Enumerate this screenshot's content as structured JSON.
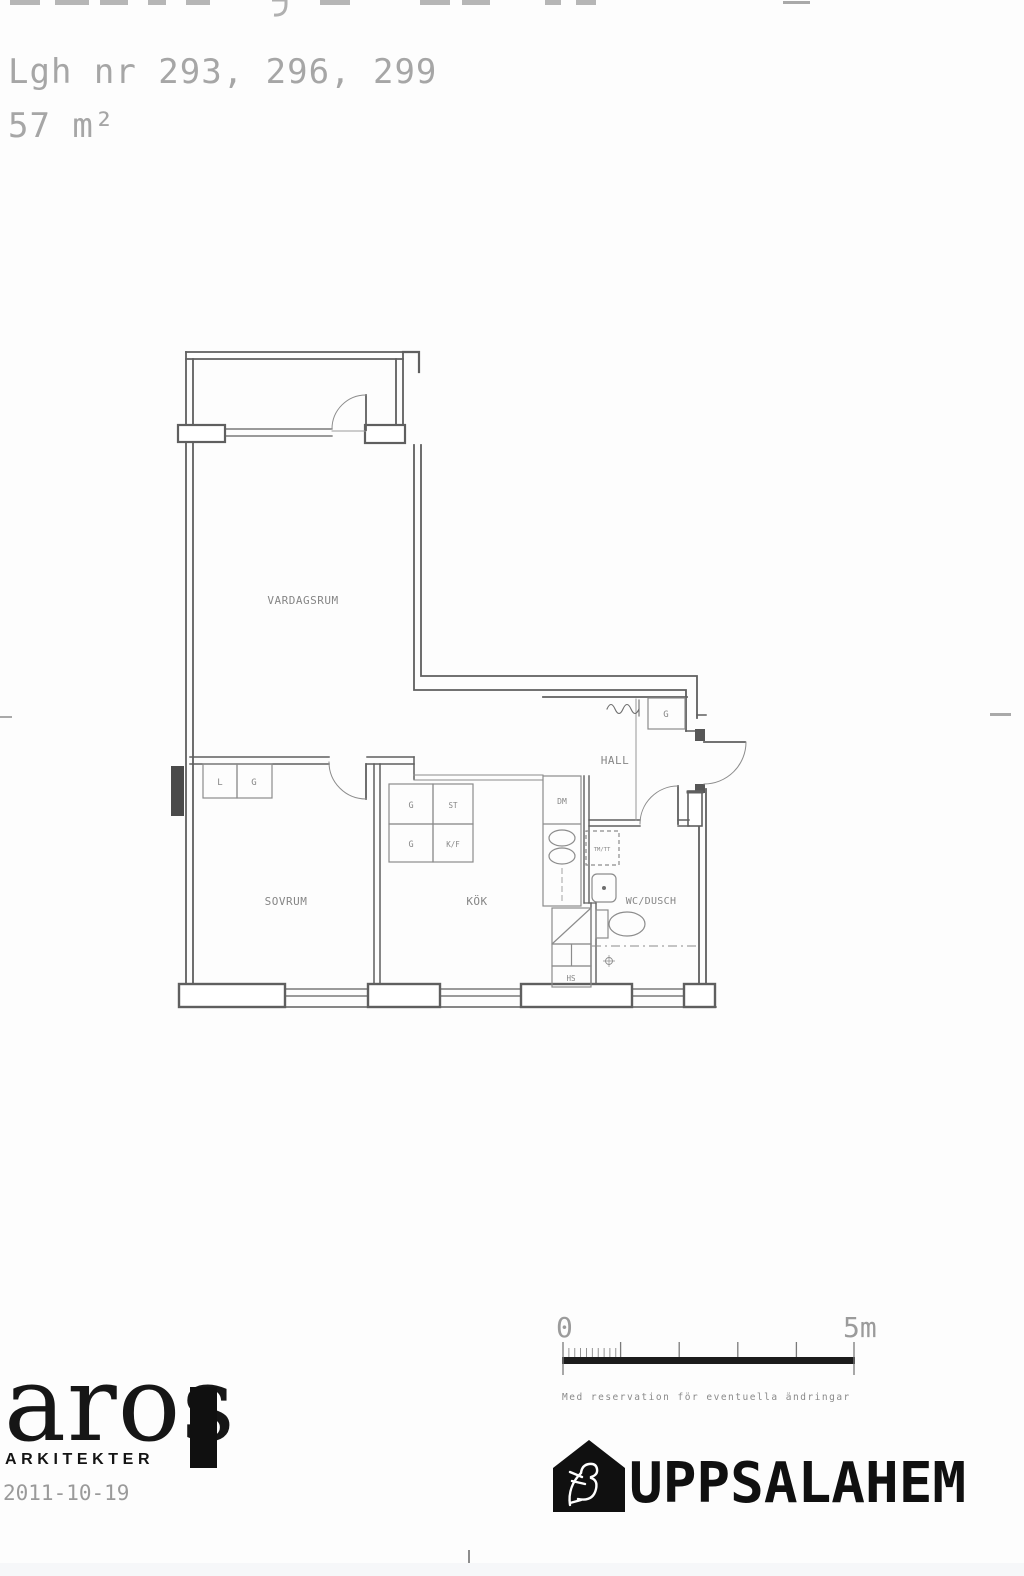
{
  "header": {
    "apartment_line": "Lgh nr 293, 296, 299",
    "area_line": "57 m²"
  },
  "plan": {
    "labels": {
      "vardagsrum": "VARDAGSRUM",
      "sovrum": "SOVRUM",
      "kok": "KÖK",
      "hall": "HALL",
      "wc_dusch": "WC/DUSCH"
    },
    "closets": {
      "l": "L",
      "g": "G",
      "hall_g": "G"
    },
    "kitchen": {
      "g1": "G",
      "st": "ST",
      "g2": "G",
      "kf": "K/F",
      "dm": "DM",
      "hs": "HS"
    },
    "laundry": "TM/TT"
  },
  "scale": {
    "zero": "0",
    "five": "5m",
    "disclaimer": "Med reservation för eventuella ändringar"
  },
  "footer": {
    "aros": {
      "name": "aros",
      "subtitle": "ARKITEKTER",
      "date": "2011-10-19"
    },
    "uppsalahem": {
      "name": "UPPSALAHEM"
    }
  },
  "colors": {
    "wall": "#5f5f5f",
    "fixture": "#8c8c8c",
    "label": "#868686",
    "header_text": "#a6a6a6",
    "logo": "#101010",
    "scalebar": "#1c1c1c"
  }
}
